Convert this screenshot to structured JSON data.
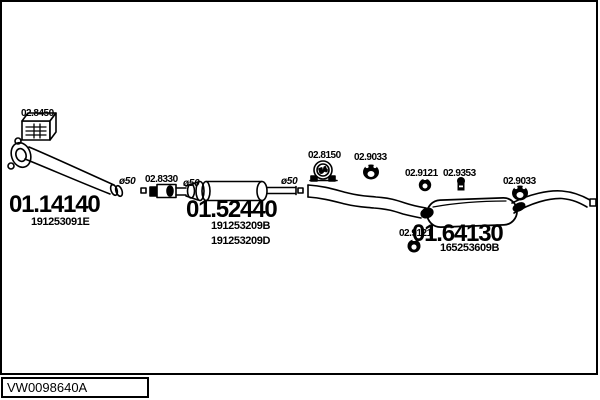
{
  "colors": {
    "ink": "#000000",
    "paper": "#ffffff"
  },
  "footer": {
    "code": "VW0098640A"
  },
  "parts": {
    "fitting_kit": {
      "label": "02.8450"
    },
    "front_pipe": {
      "label": "01.14140",
      "oem": "191253091E"
    },
    "clamp_front": {
      "label": "02.8330"
    },
    "centre_muffler": {
      "label": "01.52440",
      "oem_1": "191253209B",
      "oem_2": "191253209D"
    },
    "clamp_rear": {
      "label": "02.8150",
      "clamp_diameter": "54"
    },
    "hanger_centre": {
      "label": "02.9033"
    },
    "ring_centre": {
      "label": "02.9121"
    },
    "mount_rear": {
      "label": "02.9353"
    },
    "ring_rear": {
      "label": "02.9121"
    },
    "rear_muffler": {
      "label": "01.64130",
      "oem": "165253609B"
    },
    "hanger_tail": {
      "label": "02.9033"
    },
    "pipe_dia_1": {
      "label": "ø50"
    },
    "pipe_dia_2": {
      "label": "ø50"
    },
    "pipe_dia_3": {
      "label": "ø50"
    }
  }
}
